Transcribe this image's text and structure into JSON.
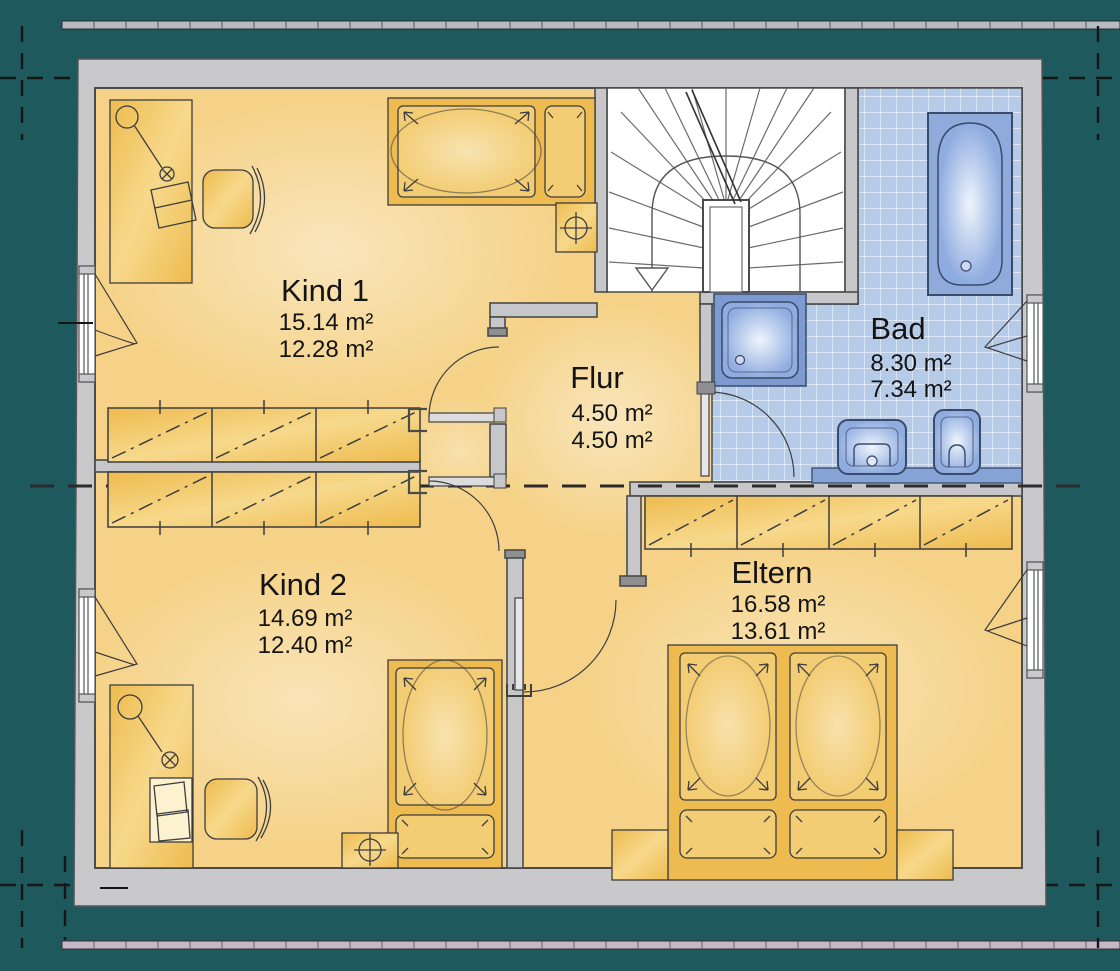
{
  "plan": {
    "type": "floor-plan-upper-storey",
    "rooms": [
      {
        "id": "kind1",
        "label": "Kind 1",
        "area_gross": "15.14 m²",
        "area_net": "12.28 m²"
      },
      {
        "id": "flur",
        "label": "Flur",
        "area_gross": "4.50 m²",
        "area_net": "4.50 m²"
      },
      {
        "id": "bad",
        "label": "Bad",
        "area_gross": "8.30 m²",
        "area_net": "7.34 m²"
      },
      {
        "id": "kind2",
        "label": "Kind 2",
        "area_gross": "14.69 m²",
        "area_net": "12.40 m²"
      },
      {
        "id": "eltern",
        "label": "Eltern",
        "area_gross": "16.58 m²",
        "area_net": "13.61 m²"
      }
    ],
    "fixtures": [
      "stairs",
      "bathtub",
      "shower",
      "washbasin",
      "toilet",
      "vanity",
      "wardrobe",
      "single-bed",
      "double-bed",
      "desk",
      "desk-chair",
      "nightstand",
      "lamp",
      "window",
      "door"
    ],
    "colors": {
      "background": "#1d595d",
      "slab_gray": "#c9c9cb",
      "wall_line": "#4a4b4d",
      "room_yellow": "#f5d287",
      "furniture_yellow": "#efc05e",
      "tile_blue": "#b6cbe8",
      "fixture_blue": "#8fabdc",
      "text": "#141414"
    }
  }
}
